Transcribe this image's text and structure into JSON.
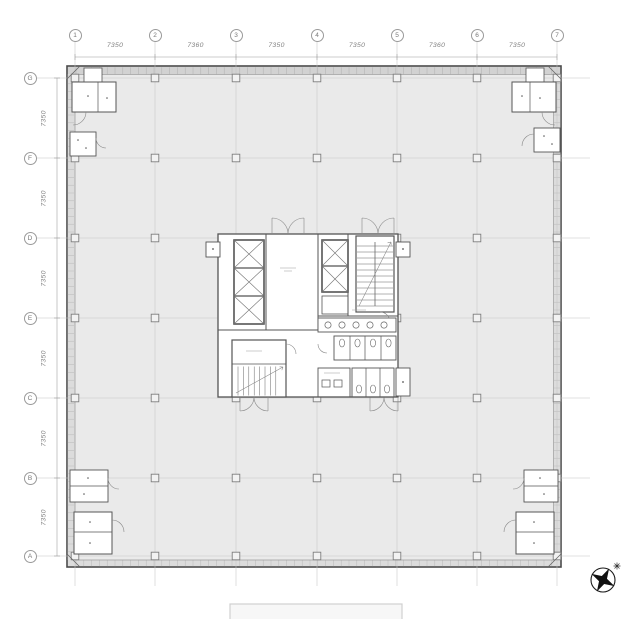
{
  "drawing": {
    "kind": "office-tower-typical-floor-plan",
    "grid": {
      "col_labels": [
        "1",
        "2",
        "3",
        "4",
        "5",
        "6",
        "7"
      ],
      "col_dims": [
        "7350",
        "7360",
        "7350",
        "7350",
        "7360",
        "7350"
      ],
      "row_labels": [
        "G",
        "F",
        "D",
        "E",
        "C",
        "B",
        "A"
      ],
      "row_dims": [
        "7350",
        "7350",
        "7350",
        "7350",
        "7350",
        "7350"
      ]
    },
    "colors": {
      "floor_fill": "#eaeaea",
      "wall_line": "#4a4a4a",
      "core_line": "#555555",
      "grid_line": "#c5c5c5",
      "dim_text": "#828282",
      "north_arrow": "#111111"
    }
  }
}
